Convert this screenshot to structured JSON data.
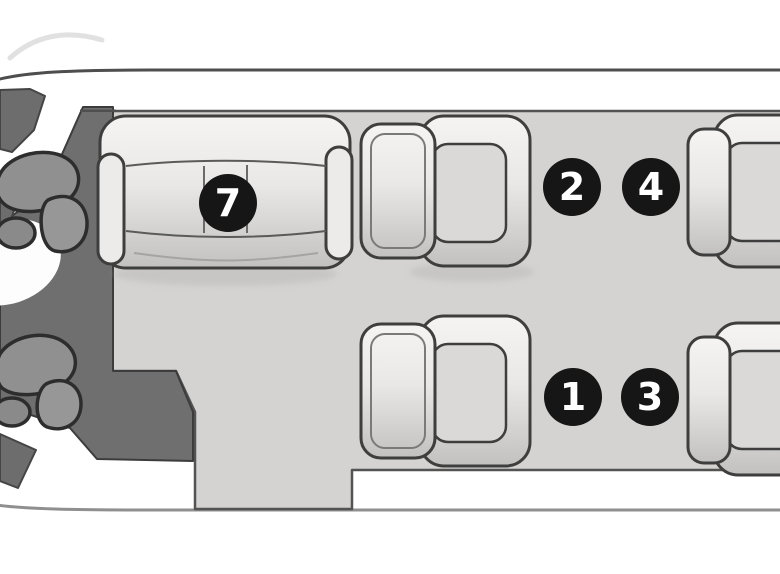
{
  "diagram": {
    "kind": "cabin-seating-floorplan"
  },
  "badges": [
    {
      "label": "7"
    },
    {
      "label": "2"
    },
    {
      "label": "4"
    },
    {
      "label": "1"
    },
    {
      "label": "3"
    }
  ],
  "colors": {
    "page_background": "#ffffff",
    "fuselage_interior": "#fdfdfd",
    "fuselage_top_line": "#4e4e4e",
    "fuselage_bottom_line": "#8f8f8f",
    "cabin_floor": "#d5d3d1",
    "floor_outline": "#535353",
    "cockpit_area": "#6f6f6f",
    "cockpit_wedge": "#6d6d6d",
    "pilot_seat": "#909090",
    "seat_outline": "#3e3e3e",
    "seat_cushion": "#dad9d7",
    "badge_background": "#161616",
    "badge_text": "#ffffff"
  }
}
